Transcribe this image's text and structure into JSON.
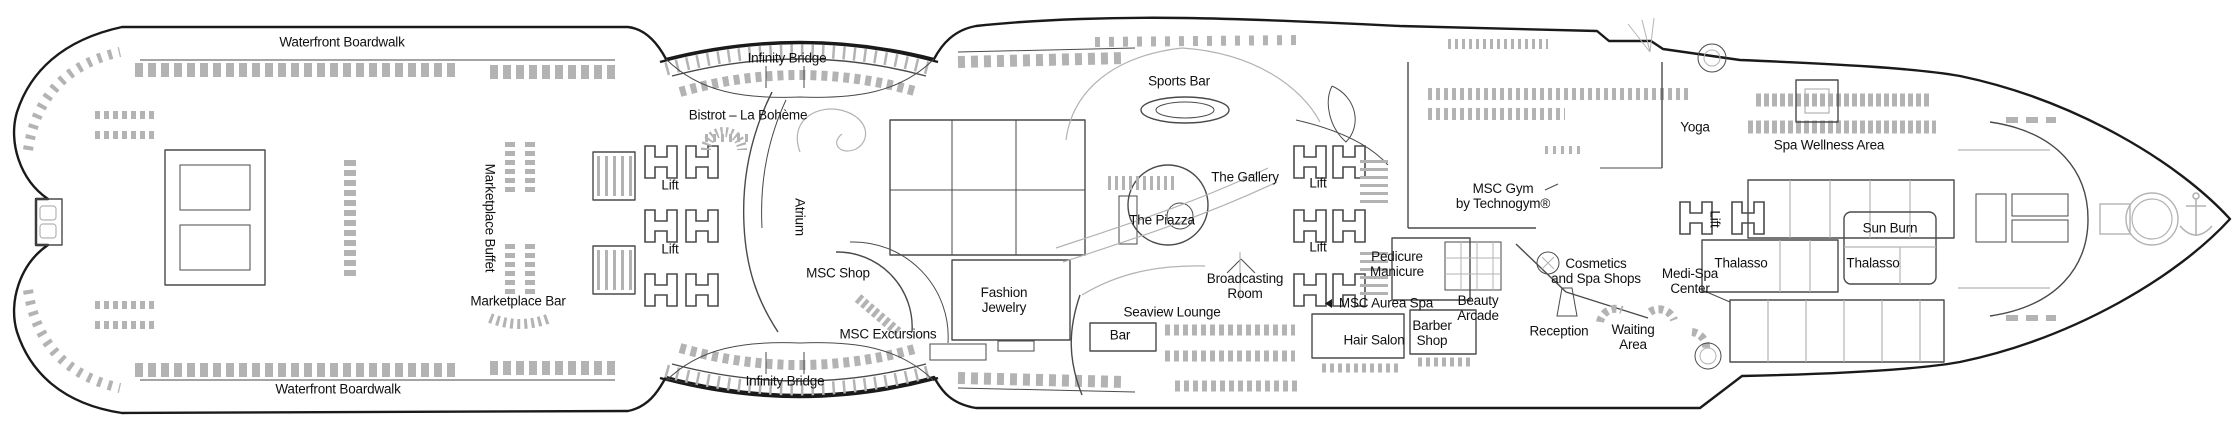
{
  "labels": {
    "waterfront_boardwalk_top": "Waterfront Boardwalk",
    "infinity_bridge_top": "Infinity Bridge",
    "bistrot_la_boheme": "Bistrot – La Bohème",
    "marketplace_buffet": "Marketplace Buffet",
    "lift_aft_upper": "Lift",
    "lift_aft_lower": "Lift",
    "atrium": "Atrium",
    "msc_shop": "MSC Shop",
    "marketplace_bar": "Marketplace Bar",
    "msc_excursions": "MSC Excursions",
    "fashion_jewelry": "Fashion\nJewelry",
    "sports_bar": "Sports Bar",
    "the_gallery": "The Gallery",
    "the_piazza": "The Piazza",
    "lift_mid_upper": "Lift",
    "lift_mid_lower": "Lift",
    "broadcasting_room": "Broadcasting\nRoom",
    "seaview_lounge": "Seaview Lounge",
    "bar": "Bar",
    "msc_aurea_spa": "MSC Aurea Spa",
    "pedicure_manicure": "Pedicure\nManicure",
    "hair_salon": "Hair Salon",
    "barber_shop": "Barber\nShop",
    "beauty_arcade": "Beauty\nArcade",
    "msc_gym": "MSC Gym\nby Technogym®",
    "cosmetics_and_spa_shops": "Cosmetics\nand Spa Shops",
    "reception": "Reception",
    "waiting_area": "Waiting\nArea",
    "medi_spa_center": "Medi-Spa\nCenter",
    "yoga": "Yoga",
    "spa_wellness_area": "Spa Wellness Area",
    "lift_spa": "Lift",
    "thalasso_port": "Thalasso",
    "sun_burn": "Sun Burn",
    "thalasso_starboard": "Thalasso",
    "infinity_bridge_bottom": "Infinity Bridge",
    "waterfront_boardwalk_bottom": "Waterfront Boardwalk"
  },
  "colors": {
    "line": "#1a1a1a",
    "wall": "#4a4a4a",
    "furniture": "#b3b3b3",
    "label_text": "#111111",
    "background": "#ffffff"
  }
}
